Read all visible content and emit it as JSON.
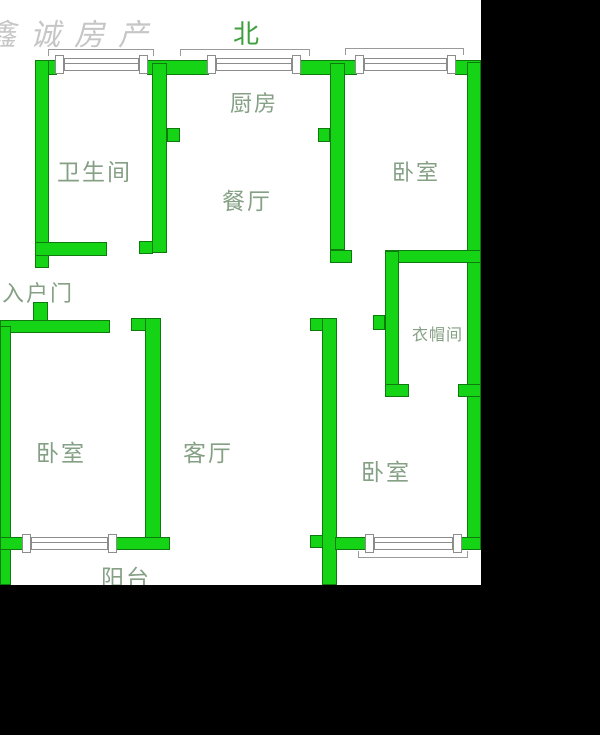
{
  "watermark": {
    "text": "鑫诚房产"
  },
  "compass": {
    "north": "北"
  },
  "rooms": {
    "kitchen": "厨房",
    "bathroom": "卫生间",
    "dining": "餐厅",
    "bedroom_top_right": "卧室",
    "entry_door": "入户门",
    "cloakroom": "衣帽间",
    "bedroom_left": "卧室",
    "living_room": "客厅",
    "bedroom_bottom_right": "卧室",
    "balcony": "阳台"
  },
  "colors": {
    "wall_fill": "#15d415",
    "wall_outline": "#0e7a0e",
    "room_label": "#85a085",
    "north_label": "#3f9f3f",
    "watermark": "#c6c6c6",
    "window_outline": "#8c8c8c",
    "floor_background": "#ffffff",
    "mask": "#000000"
  }
}
